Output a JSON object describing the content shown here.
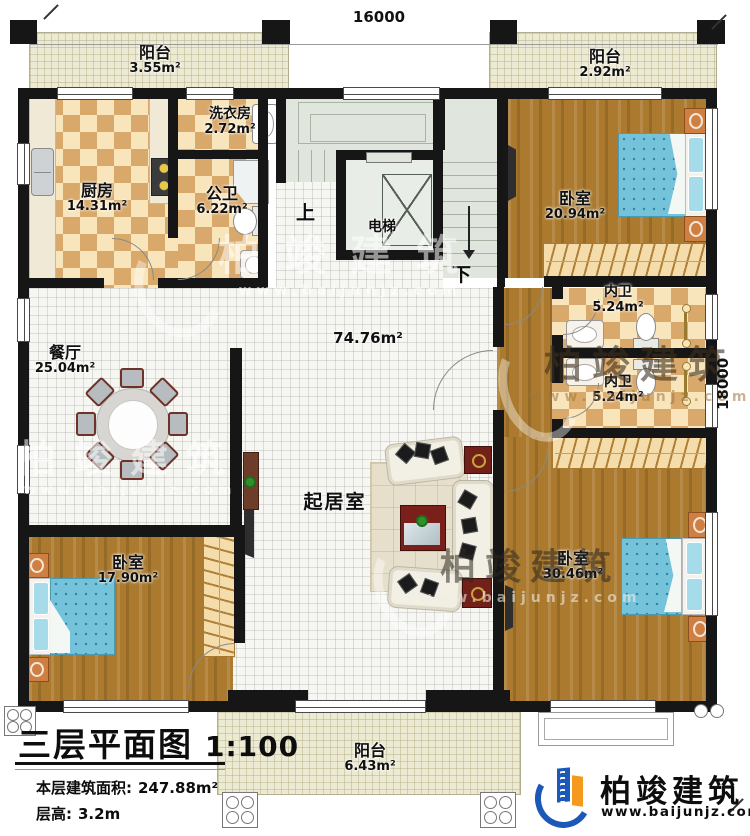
{
  "dimensions": {
    "top": "16000",
    "right": "18000"
  },
  "stair": {
    "elevator": "电梯",
    "up": "上",
    "down": "下"
  },
  "rooms": {
    "balcony_top_left": {
      "name": "阳台",
      "area": "3.55m²"
    },
    "balcony_top_right": {
      "name": "阳台",
      "area": "2.92m²"
    },
    "kitchen": {
      "name": "厨房",
      "area": "14.31m²"
    },
    "laundry": {
      "name": "洗衣房",
      "area": "2.72m²"
    },
    "public_bath": {
      "name": "公卫",
      "area": "6.22m²"
    },
    "bedroom_top_right": {
      "name": "卧室",
      "area": "20.94m²"
    },
    "inner_bath_top": {
      "name": "内卫",
      "area": "5.24m²"
    },
    "inner_bath_bottom": {
      "name": "内卫",
      "area": "5.24m²"
    },
    "dining": {
      "name": "餐厅",
      "area": "25.04m²"
    },
    "living": {
      "name": "起居室",
      "area": "74.76m²"
    },
    "bedroom_bottom_left": {
      "name": "卧室",
      "area": "17.90m²"
    },
    "bedroom_bottom_right": {
      "name": "卧室",
      "area": "30.46m²"
    },
    "balcony_bottom": {
      "name": "阳台",
      "area": "6.43m²"
    }
  },
  "title_block": {
    "title": "三层平面图",
    "scale": "1:100",
    "area_label": "本层建筑面积:",
    "area_value": "247.88m²",
    "height_label": "层高:",
    "height_value": "3.2m"
  },
  "logo": {
    "company": "柏竣建筑",
    "website": "www.baijunjz.com"
  },
  "watermark": {
    "company": "柏竣建筑",
    "website": "www.baijunjz.com"
  }
}
